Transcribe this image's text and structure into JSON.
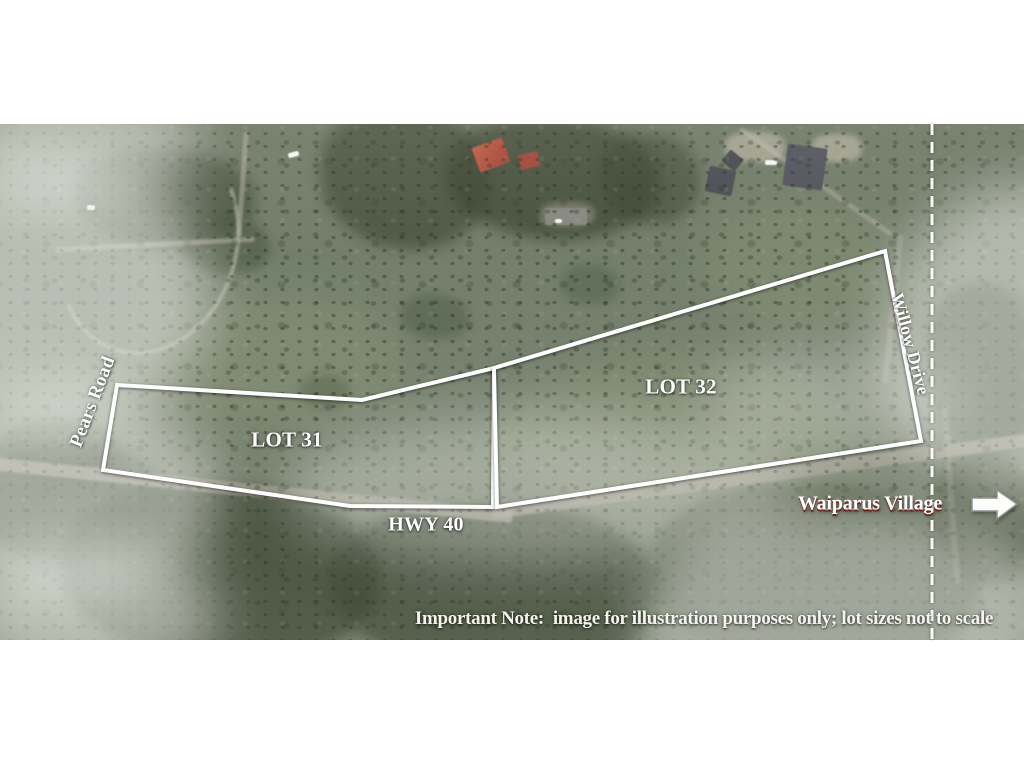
{
  "map": {
    "description": "aerial lot map",
    "labels": {
      "lot31": "LOT 31",
      "lot32": "LOT 32",
      "hwy": "HWY 40",
      "pears_road": "Pears Road",
      "willow_drive": "Willow Drive",
      "waiparus_village": "Waiparus Village",
      "note": "Important Note:  image for illustration purposes only; lot sizes not to scale"
    },
    "colors": {
      "lot_outline": "#ffffff",
      "label_text": "#ffffff",
      "waiparus_shadow": "#7a1d15",
      "dashed_line": "#ffffff",
      "arrow_fill": "#fdfdfc"
    },
    "icons": {
      "direction_arrow": "right-arrow"
    }
  }
}
